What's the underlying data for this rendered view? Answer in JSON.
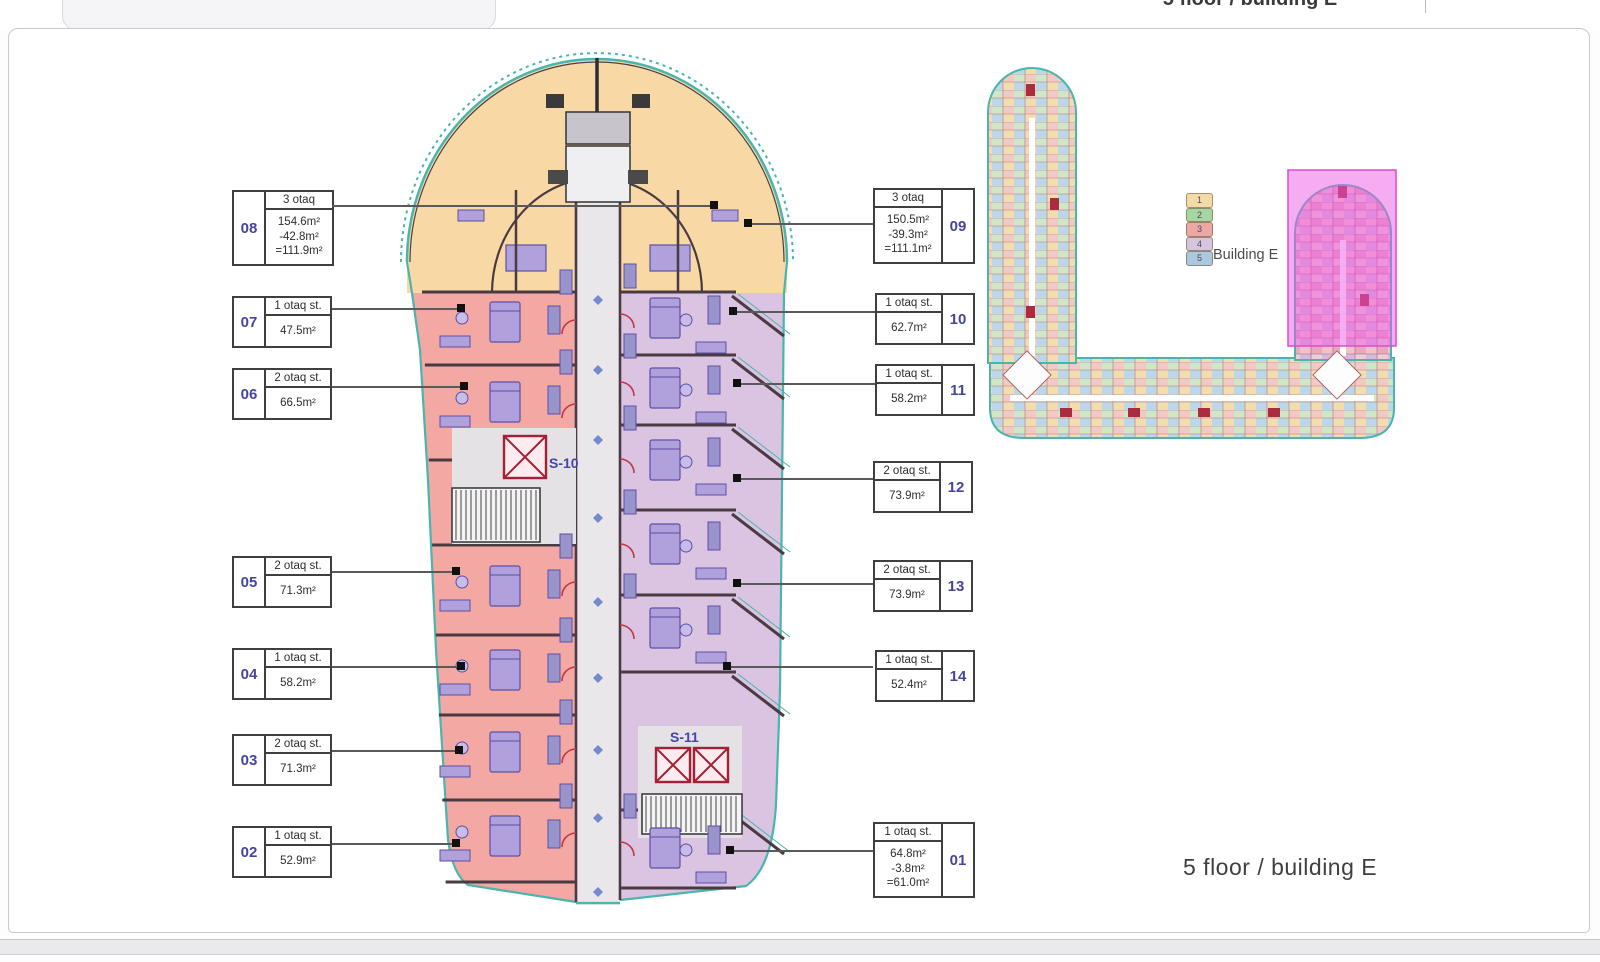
{
  "header": {
    "tab_title": "5 floor / building E"
  },
  "footer_title": "5 floor / building E",
  "legend": {
    "label": "Building E",
    "floors": [
      {
        "num": "1",
        "color": "#f4d9a4"
      },
      {
        "num": "2",
        "color": "#a2d4a0"
      },
      {
        "num": "3",
        "color": "#eda4a2"
      },
      {
        "num": "4",
        "color": "#d5c2de"
      },
      {
        "num": "5",
        "color": "#a8c6dd"
      }
    ]
  },
  "units_left": [
    {
      "num": "08",
      "type": "3 otaq",
      "areas": [
        "154.6m²",
        "-42.8m²",
        "=111.9m²"
      ]
    },
    {
      "num": "07",
      "type": "1 otaq st.",
      "areas": [
        "47.5m²"
      ]
    },
    {
      "num": "06",
      "type": "2 otaq st.",
      "areas": [
        "66.5m²"
      ]
    },
    {
      "num": "05",
      "type": "2 otaq st.",
      "areas": [
        "71.3m²"
      ]
    },
    {
      "num": "04",
      "type": "1 otaq st.",
      "areas": [
        "58.2m²"
      ]
    },
    {
      "num": "03",
      "type": "2 otaq st.",
      "areas": [
        "71.3m²"
      ]
    },
    {
      "num": "02",
      "type": "1 otaq st.",
      "areas": [
        "52.9m²"
      ]
    }
  ],
  "units_right": [
    {
      "num": "09",
      "type": "3 otaq",
      "areas": [
        "150.5m²",
        "-39.3m²",
        "=111.1m²"
      ]
    },
    {
      "num": "10",
      "type": "1 otaq st.",
      "areas": [
        "62.7m²"
      ]
    },
    {
      "num": "11",
      "type": "1 otaq st.",
      "areas": [
        "58.2m²"
      ]
    },
    {
      "num": "12",
      "type": "2 otaq st.",
      "areas": [
        "73.9m²"
      ]
    },
    {
      "num": "13",
      "type": "2 otaq st.",
      "areas": [
        "73.9m²"
      ]
    },
    {
      "num": "14",
      "type": "1 otaq st.",
      "areas": [
        "52.4m²"
      ]
    },
    {
      "num": "01",
      "type": "1 otaq st.",
      "areas": [
        "64.8m²",
        "-3.8m²",
        "=61.0m²"
      ]
    }
  ],
  "plan": {
    "stairs": [
      "S-10",
      "S-11"
    ]
  },
  "colors": {
    "arch_top": "#f8d9a6",
    "left_wing": "#f3a8a3",
    "right_wing": "#dac4e1",
    "corridor": "#e9e7e9",
    "outline_teal": "#4ab5ad",
    "wall_dark": "#443a40",
    "elevator_red": "#a32035",
    "furniture_purple": "#b0a0dc",
    "highlight_magenta": "#ee5ae3"
  }
}
